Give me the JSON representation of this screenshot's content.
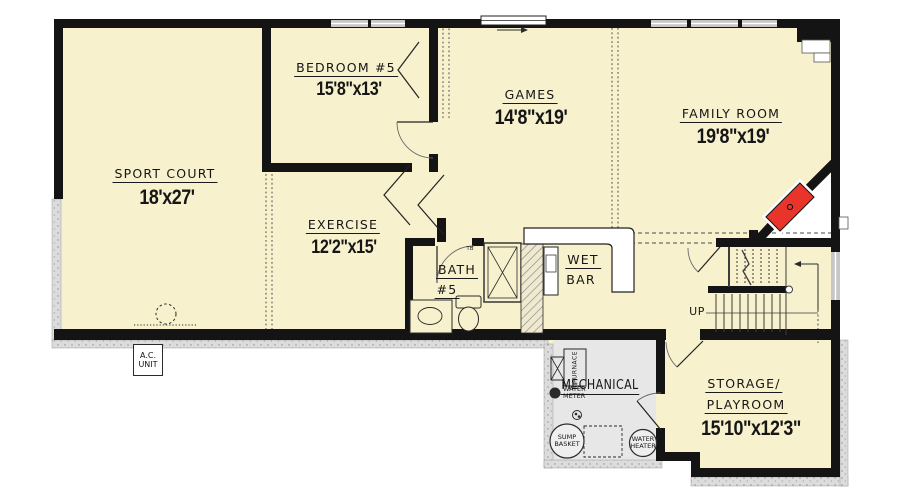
{
  "plan_title": "Basement Floor Plan",
  "rooms": {
    "sport_court": {
      "name": "SPORT COURT",
      "dims": "18'x27'"
    },
    "bedroom5": {
      "name": "BEDROOM #5",
      "dims": "15'8\"x13'"
    },
    "games": {
      "name": "GAMES",
      "dims": "14'8\"x19'"
    },
    "family_room": {
      "name": "FAMILY ROOM",
      "dims": "19'8\"x19'"
    },
    "exercise": {
      "name": "EXERCISE",
      "dims": "12'2\"x15'"
    },
    "bath5": {
      "line1": "BATH",
      "line2": "#5"
    },
    "wet_bar": {
      "line1": "WET",
      "line2": "BAR"
    },
    "mechanical": {
      "name": "MECHANICAL"
    },
    "storage_playroom": {
      "line1": "STORAGE/",
      "line2": "PLAYROOM",
      "dims": "15'10\"x12'3\""
    }
  },
  "labels": {
    "up": "UP",
    "tb": "TB",
    "ac_unit": {
      "line1": "A.C.",
      "line2": "UNIT"
    },
    "furnace": "FURNACE",
    "water_meter": {
      "line1": "WATER",
      "line2": "METER"
    },
    "sump_basket": {
      "line1": "SUMP",
      "line2": "BASKET"
    },
    "water_heater": {
      "line1": "WATER",
      "line2": "HEATER"
    }
  },
  "colors": {
    "floor": "#f7f1cd",
    "wall": "#141414",
    "mechanical_floor": "#e7e7e7",
    "fireplace_red": "#e8342b",
    "window_gray": "#c6c6c6",
    "foundation_gray": "#dcdcdc"
  }
}
